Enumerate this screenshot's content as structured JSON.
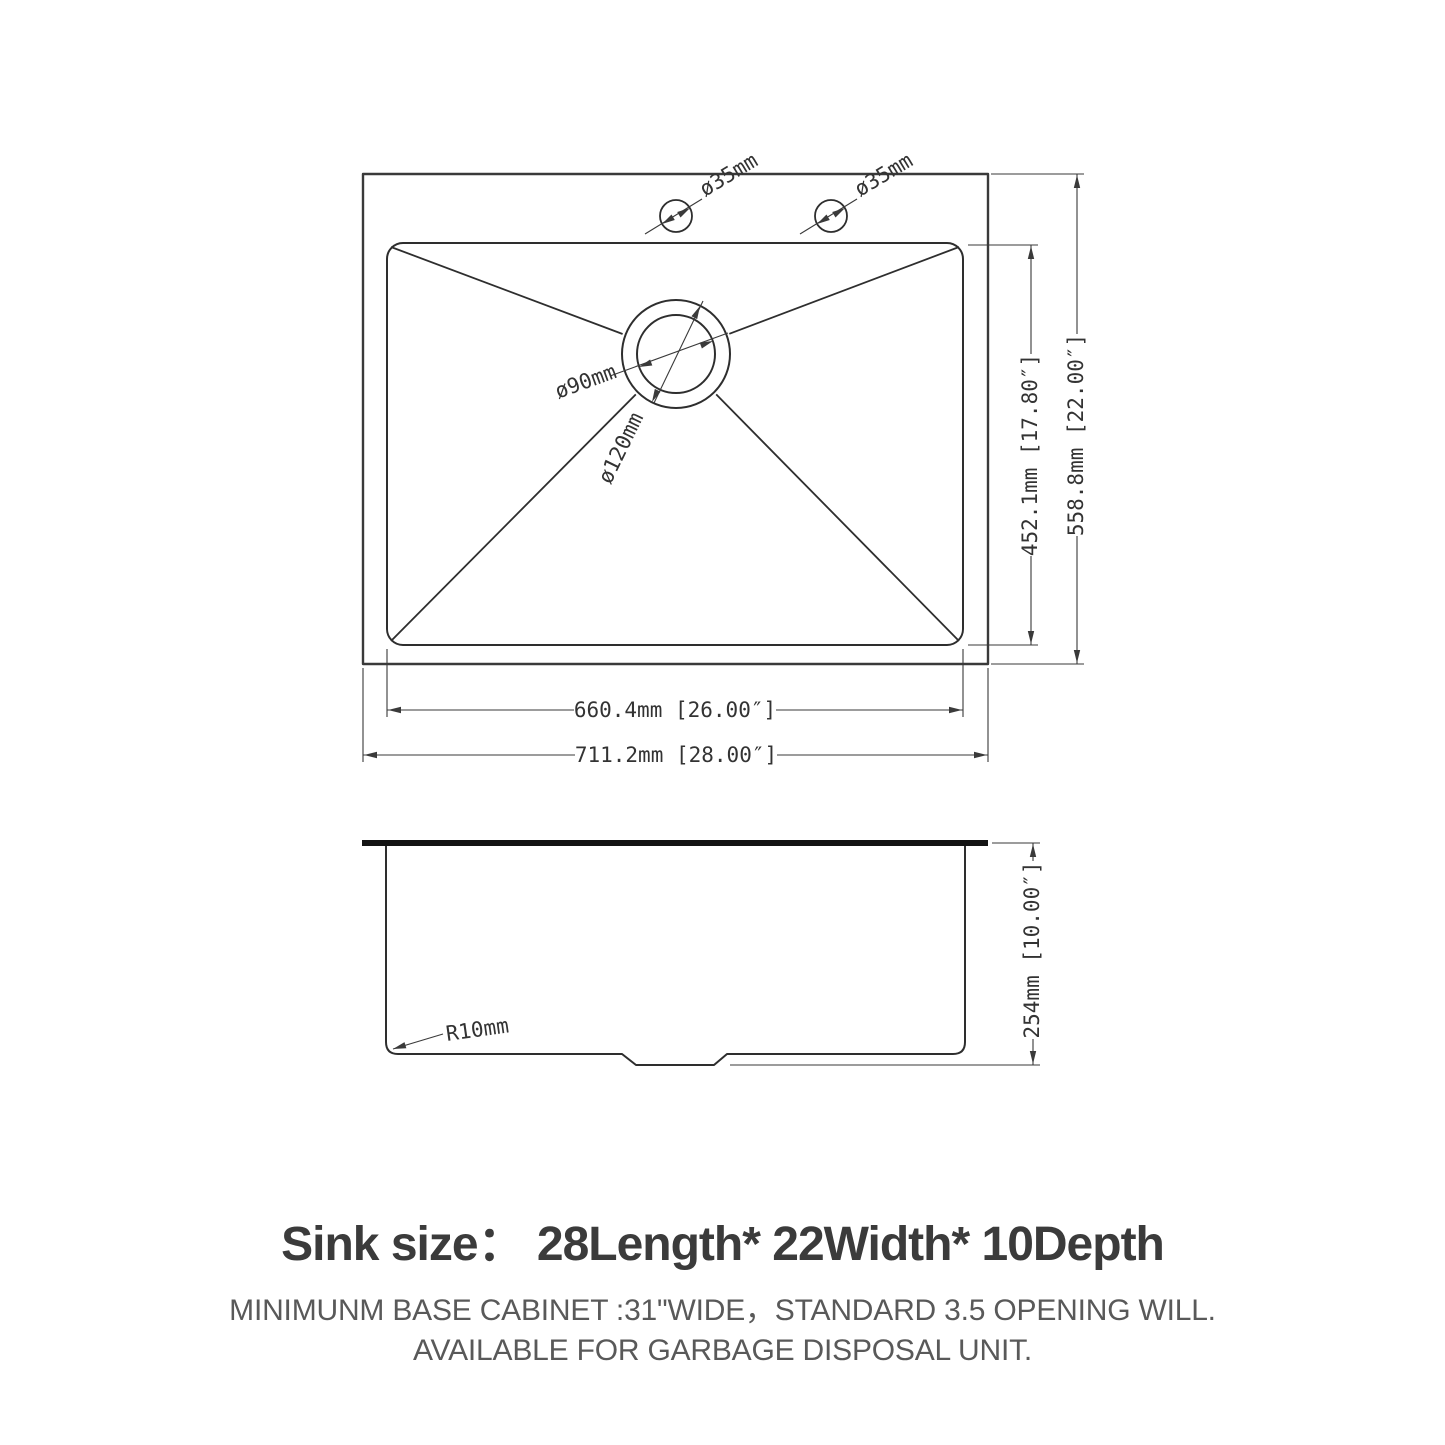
{
  "drawing": {
    "top_view": {
      "hole_left_label": "ø35mm",
      "hole_right_label": "ø35mm",
      "drain_inner_label": "ø90mm",
      "drain_outer_label": "ø120mm",
      "bowl_height_label": "452.1mm [17.80″]",
      "overall_height_label": "558.8mm [22.00″]",
      "bowl_width_label": "660.4mm [26.00″]",
      "overall_width_label": "711.2mm [28.00″]"
    },
    "side_view": {
      "corner_radius_label": "R10mm",
      "depth_label": "254mm [10.00″]"
    }
  },
  "footer": {
    "heading": "Sink size：  28Length* 22Width* 10Depth",
    "note_line1": "MINIMUNM BASE CABINET :31\"WIDE，STANDARD 3.5 OPENING WILL.",
    "note_line2": "AVAILABLE FOR GARBAGE DISPOSAL UNIT."
  },
  "colors": {
    "line": "#333333",
    "outline": "#2e2e2e",
    "rim_bar": "#141414",
    "heading_text": "#3b3b3b",
    "note_text": "#595959"
  }
}
